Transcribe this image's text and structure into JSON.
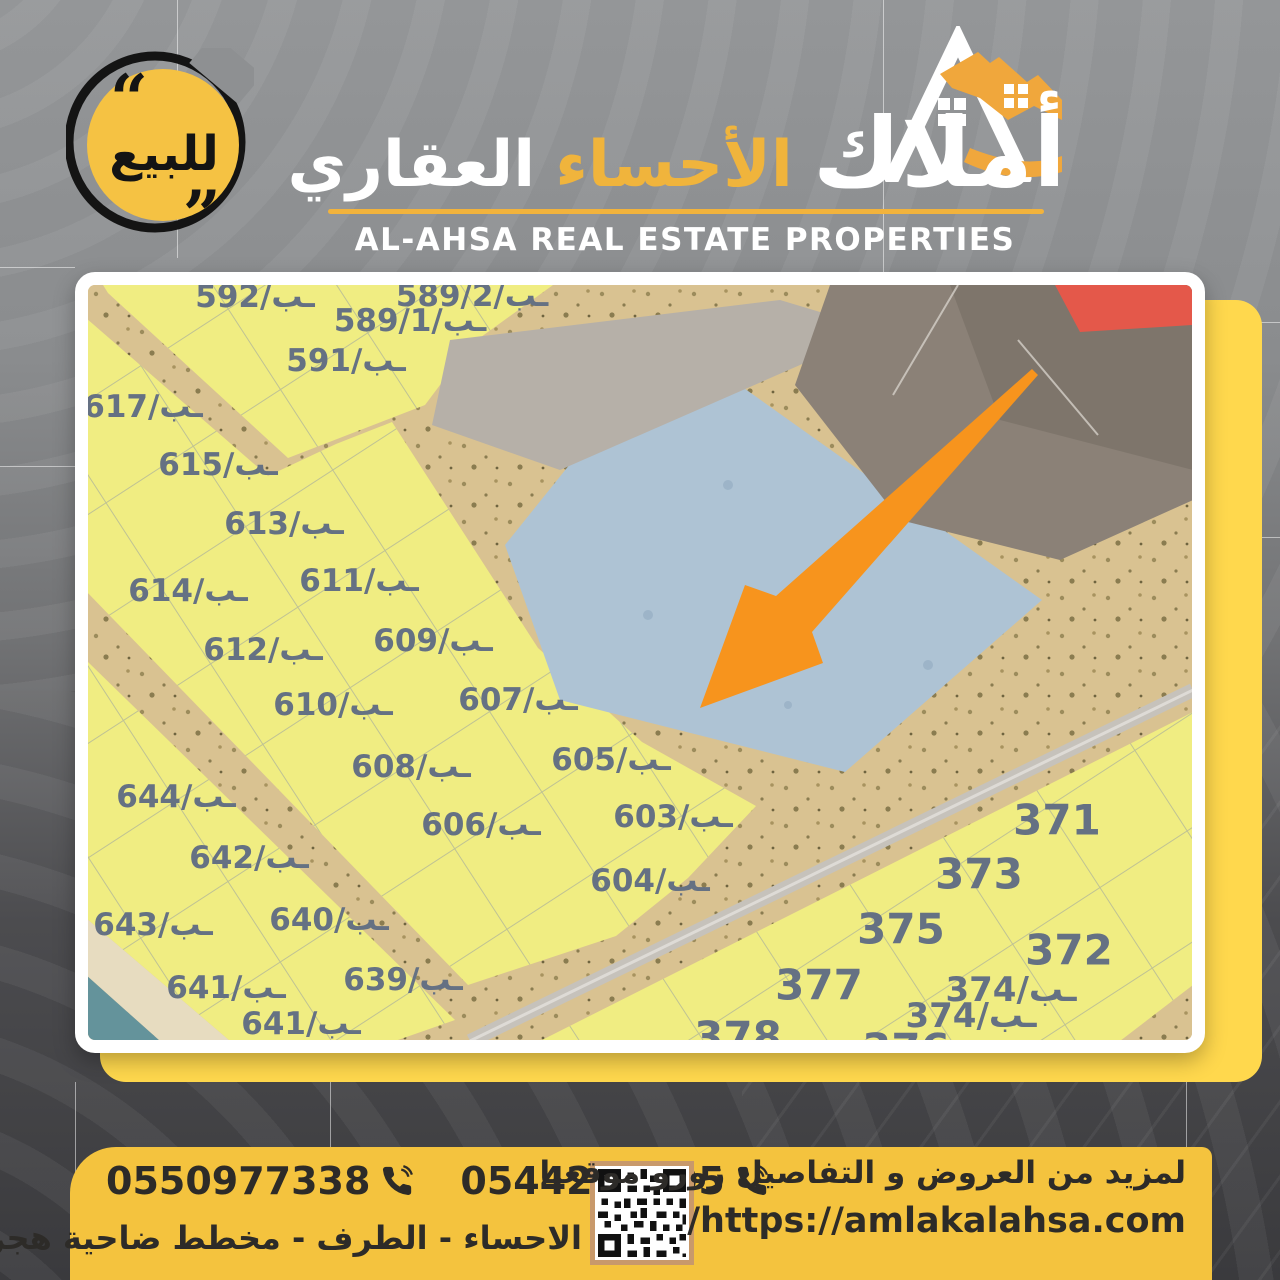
{
  "badge": {
    "label": "للبيع"
  },
  "header": {
    "brand_arabic_main": "أملاك",
    "brand_arabic_mid": "الأحساء",
    "brand_arabic_end": "العقاري",
    "brand_english": "AL-AHSA REAL ESTATE PROPERTIES"
  },
  "map": {
    "colors": {
      "sand": "#d9c291",
      "plot_fill": "#f0ed82",
      "blue_region": "#aec3d4",
      "light_strip": "#b6b0a8",
      "dark_plots": "#8b8177",
      "dark_plots2": "#7e756b",
      "red_plot": "#e4584a",
      "gray_road": "#c6c2bb",
      "water": "#64939b",
      "beach": "#e7dcc0",
      "label": "#657183",
      "arrow": "#f7941d"
    },
    "plots": [
      {
        "label": "592/ـب",
        "x": 167,
        "y": 12,
        "fs": 31
      },
      {
        "label": "589/2/ـب",
        "x": 384,
        "y": 11,
        "fs": 31
      },
      {
        "label": "589/1/ـب",
        "x": 322,
        "y": 36,
        "fs": 31
      },
      {
        "label": "591/ـب",
        "x": 258,
        "y": 76,
        "fs": 31
      },
      {
        "label": "617/ـب",
        "x": 55,
        "y": 122,
        "fs": 31
      },
      {
        "label": "615/ـب",
        "x": 130,
        "y": 180,
        "fs": 31
      },
      {
        "label": "613/ـب",
        "x": 196,
        "y": 239,
        "fs": 31
      },
      {
        "label": "611/ـب",
        "x": 271,
        "y": 296,
        "fs": 31
      },
      {
        "label": "614/ـب",
        "x": 100,
        "y": 306,
        "fs": 31
      },
      {
        "label": "612/ـب",
        "x": 175,
        "y": 365,
        "fs": 31
      },
      {
        "label": "609/ـب",
        "x": 345,
        "y": 356,
        "fs": 31
      },
      {
        "label": "610/ـب",
        "x": 245,
        "y": 420,
        "fs": 31
      },
      {
        "label": "607/ـب",
        "x": 430,
        "y": 415,
        "fs": 31
      },
      {
        "label": "608/ـب",
        "x": 323,
        "y": 482,
        "fs": 31
      },
      {
        "label": "605/ـب",
        "x": 523,
        "y": 475,
        "fs": 31
      },
      {
        "label": "606/ـب",
        "x": 393,
        "y": 540,
        "fs": 31
      },
      {
        "label": "603/ـب",
        "x": 585,
        "y": 532,
        "fs": 31
      },
      {
        "label": "604/ـب",
        "x": 562,
        "y": 596,
        "fs": 31
      },
      {
        "label": "644/ـب",
        "x": 88,
        "y": 512,
        "fs": 31
      },
      {
        "label": "642/ـب",
        "x": 161,
        "y": 573,
        "fs": 31
      },
      {
        "label": "643/ـب",
        "x": 65,
        "y": 640,
        "fs": 31
      },
      {
        "label": "640/ـب",
        "x": 241,
        "y": 635,
        "fs": 31
      },
      {
        "label": "641/ـب",
        "x": 138,
        "y": 703,
        "fs": 31
      },
      {
        "label": "639/ـب",
        "x": 315,
        "y": 695,
        "fs": 31
      },
      {
        "label": "641/ـب",
        "x": 213,
        "y": 739,
        "fs": 31
      },
      {
        "label": "371",
        "x": 969,
        "y": 535,
        "fs": 42
      },
      {
        "label": "373",
        "x": 891,
        "y": 589,
        "fs": 42
      },
      {
        "label": "375",
        "x": 813,
        "y": 644,
        "fs": 42
      },
      {
        "label": "372",
        "x": 981,
        "y": 665,
        "fs": 42
      },
      {
        "label": "377",
        "x": 731,
        "y": 700,
        "fs": 42
      },
      {
        "label": "374/ـب",
        "x": 923,
        "y": 705,
        "fs": 34
      },
      {
        "label": "374/ـب",
        "x": 883,
        "y": 731,
        "fs": 34
      },
      {
        "label": "378",
        "x": 650,
        "y": 752,
        "fs": 42
      },
      {
        "label": "376",
        "x": 818,
        "y": 764,
        "fs": 42
      }
    ]
  },
  "footer": {
    "phone_left": "0550977338",
    "phone_right": "0544299895",
    "location": "الاحساء - الطرف - مخطط ضاحية هجر",
    "cta": "لمزيد من العروض و التفاصيل زورو موقعنا",
    "website": "/https://amlakalahsa.com"
  }
}
